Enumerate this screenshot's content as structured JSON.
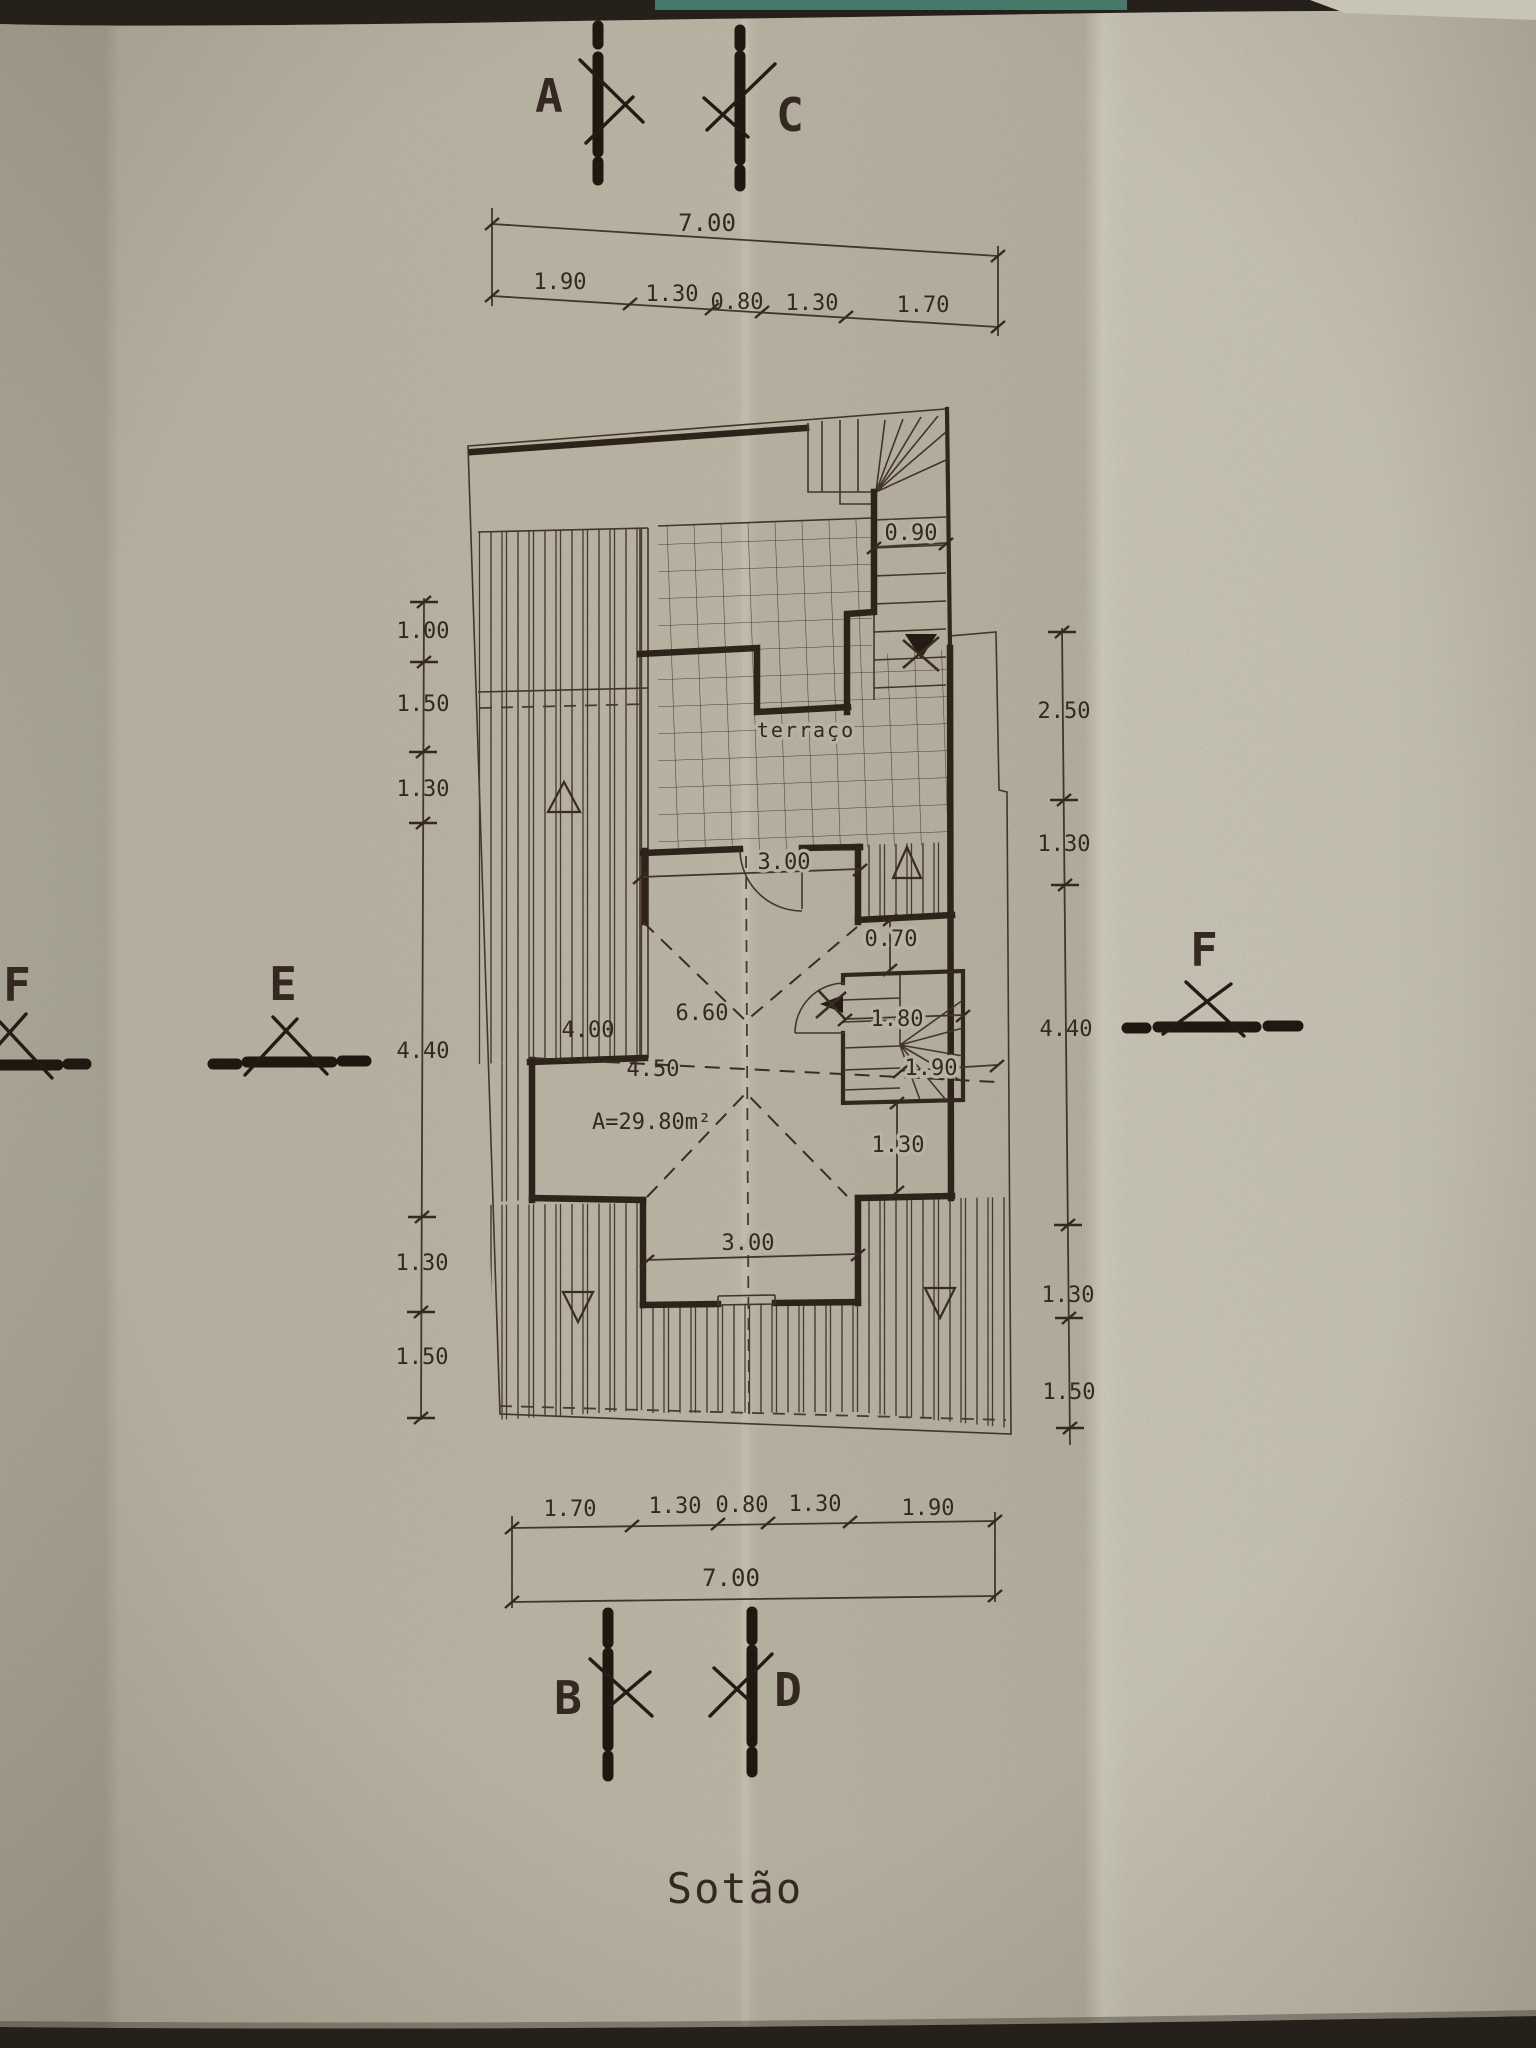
{
  "title": "Sotão",
  "markers": {
    "a": "A",
    "c": "C",
    "b": "B",
    "d": "D",
    "e": "E",
    "f_left": "F",
    "f_right": "F"
  },
  "dims": {
    "top": {
      "total": "7.00",
      "segs": [
        "1.90",
        "1.30",
        "0.80",
        "1.30",
        "1.70"
      ]
    },
    "bottom": {
      "total": "7.00",
      "segs": [
        "1.70",
        "1.30",
        "0.80",
        "1.30",
        "1.90"
      ]
    },
    "left": {
      "segs": [
        "1.00",
        "1.50",
        "1.30",
        "4.40",
        "1.30",
        "1.50"
      ]
    },
    "right": {
      "segs": [
        "2.50",
        "1.30",
        "4.40",
        "1.30",
        "1.50"
      ]
    }
  },
  "plan": {
    "terrace_label": "terraço",
    "stair_width": "0.90",
    "top_bay_width": "3.00",
    "offset": "0.70",
    "room_width": "6.60",
    "room_left": "4.00",
    "room_mid": "4.50",
    "stair_dim_1": "1.80",
    "stair_dim_2": "1.90",
    "below_stair": "1.30",
    "bottom_bay_width": "3.00",
    "area_label": "A=29.80m²"
  },
  "colors": {
    "paper": "#b8b3a2",
    "ink": "#3a2c22",
    "edge": "#26201b",
    "teal_sliver": "#47796a"
  }
}
